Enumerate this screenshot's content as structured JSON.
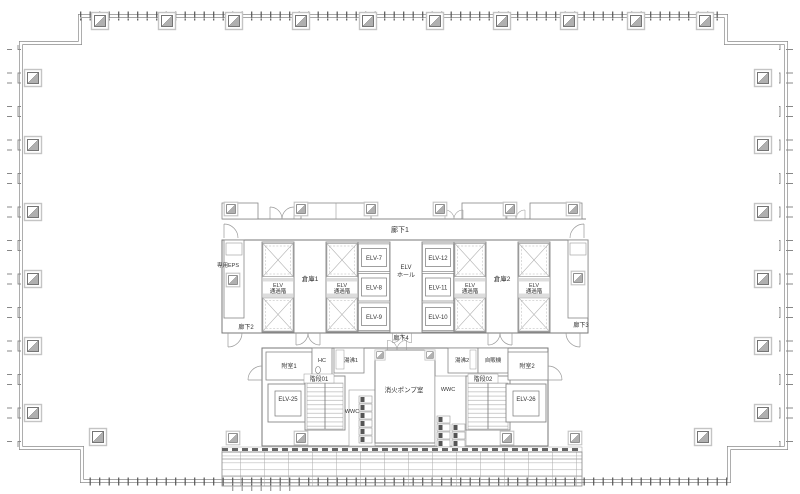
{
  "plan": {
    "corridors": {
      "c1": "廊下1",
      "c2": "廊下2",
      "c3": "廊下3",
      "c4": "廊下4"
    },
    "labels": {
      "eps": "専用EPS",
      "pass1": "ELV",
      "pass2": "通過階",
      "hall1": "ELV",
      "hall2": "ホール",
      "souko1": "倉庫1",
      "souko2": "倉庫2",
      "fushitsu1": "附室1",
      "fushitsu2": "附室2",
      "hc": "HC",
      "yuwakashi1": "湯沸1",
      "yuwakashi2": "湯沸2",
      "jihanki": "自販機",
      "kaidan01": "階段01",
      "kaidan02": "階段02",
      "pump": "消火ポンプ室",
      "wwc_left": "WWC",
      "wwc_right": "WWC"
    },
    "elevators": {
      "e7": "ELV-7",
      "e8": "ELV-8",
      "e9": "ELV-9",
      "e10": "ELV-10",
      "e11": "ELV-11",
      "e12": "ELV-12",
      "e25": "ELV-25",
      "e26": "ELV-26"
    },
    "colors": {
      "wall": "#8a8a8a",
      "thin": "#9a9a9a",
      "dark": "#555555",
      "text": "#333333",
      "shade": "#b0b0b0",
      "light": "#dddddd",
      "bg": "#ffffff"
    }
  }
}
